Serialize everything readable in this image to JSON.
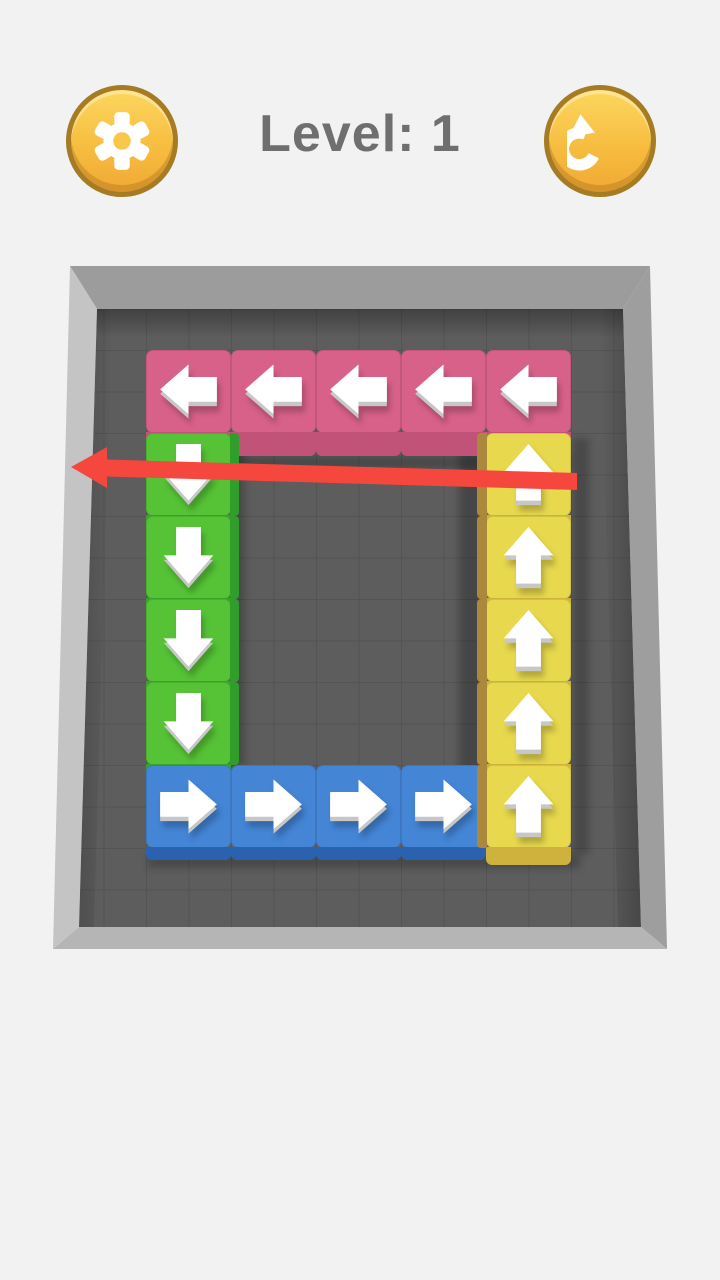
{
  "header": {
    "title": "Level: 1",
    "level": 1,
    "settings_button": {
      "icon": "gear-icon"
    },
    "restart_button": {
      "icon": "restart-rotate-icon"
    }
  },
  "colors": {
    "page_background": "#f2f2f2",
    "title_text": "#6f6f6f",
    "button": {
      "fill_top": "#fcd75e",
      "fill_bottom": "#f0a935",
      "border": "#a57b24",
      "icon": "#ffffff"
    },
    "board": {
      "floor": "#5d5d5d",
      "wall_top": "#9c9c9c",
      "wall_left": "#c4c4c4",
      "wall_right": "#9e9e9e",
      "wall_bottom": "#b5b5b5"
    },
    "blocks": {
      "pink": {
        "top": "#d8618a",
        "front": "#c05377"
      },
      "green": {
        "top": "#56c336",
        "front": "#37a32c",
        "side": "#2f9e2b"
      },
      "yellow": {
        "top": "#e7d84d",
        "front": "#cfb23e",
        "side": "#ac883c"
      },
      "blue": {
        "top": "#4485d6",
        "front": "#2b62b0"
      }
    },
    "block_arrow": "#ffffff",
    "hint_arrow": "#f5473d"
  },
  "board": {
    "grid": {
      "rows": 6,
      "cols": 5
    },
    "hint_arrow": {
      "direction": "left",
      "purpose": "tutorial-swipe-hint"
    },
    "blocks": [
      {
        "color": "pink",
        "direction": "left",
        "row": 0,
        "col": 0
      },
      {
        "color": "pink",
        "direction": "left",
        "row": 0,
        "col": 1
      },
      {
        "color": "pink",
        "direction": "left",
        "row": 0,
        "col": 2
      },
      {
        "color": "pink",
        "direction": "left",
        "row": 0,
        "col": 3
      },
      {
        "color": "pink",
        "direction": "left",
        "row": 0,
        "col": 4
      },
      {
        "color": "green",
        "direction": "down",
        "row": 1,
        "col": 0
      },
      {
        "color": "green",
        "direction": "down",
        "row": 2,
        "col": 0
      },
      {
        "color": "green",
        "direction": "down",
        "row": 3,
        "col": 0
      },
      {
        "color": "green",
        "direction": "down",
        "row": 4,
        "col": 0
      },
      {
        "color": "yellow",
        "direction": "up",
        "row": 1,
        "col": 4
      },
      {
        "color": "yellow",
        "direction": "up",
        "row": 2,
        "col": 4
      },
      {
        "color": "yellow",
        "direction": "up",
        "row": 3,
        "col": 4
      },
      {
        "color": "yellow",
        "direction": "up",
        "row": 4,
        "col": 4
      },
      {
        "color": "blue",
        "direction": "right",
        "row": 5,
        "col": 0
      },
      {
        "color": "blue",
        "direction": "right",
        "row": 5,
        "col": 1
      },
      {
        "color": "blue",
        "direction": "right",
        "row": 5,
        "col": 2
      },
      {
        "color": "blue",
        "direction": "right",
        "row": 5,
        "col": 3
      },
      {
        "color": "yellow",
        "direction": "up",
        "row": 5,
        "col": 4
      }
    ]
  }
}
